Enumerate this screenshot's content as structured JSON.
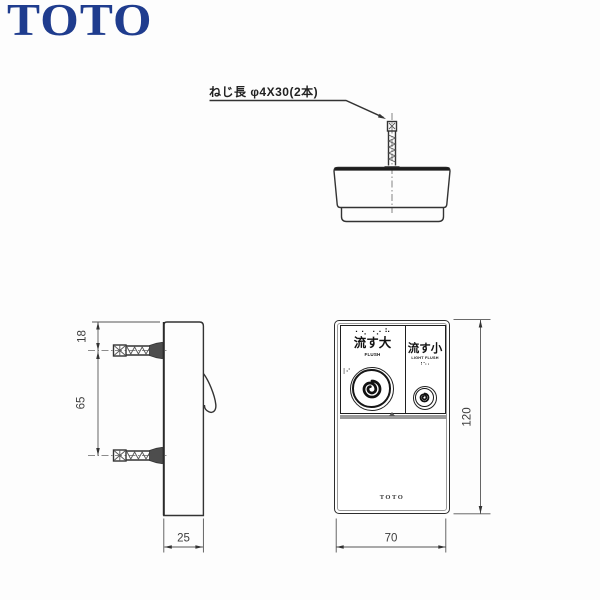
{
  "page": {
    "background": "#fdfdfd"
  },
  "header": {
    "brand_logo": "TOTO",
    "brand_color": "#1f3c8e"
  },
  "annotation": {
    "screw_note": "ねじ長 φ4X30(2本)"
  },
  "dimensions": {
    "top_to_first_screw": "18",
    "screw_spacing": "65",
    "depth": "25",
    "width": "70",
    "height": "120"
  },
  "front_view": {
    "large_flush_button": {
      "braille_top": "⠂⠢ ⠐⠔ ⠓",
      "label": "流す大",
      "sublabel": "FLUSH",
      "braille_side": "⠸⠊",
      "icon": "swirl-icon"
    },
    "light_flush_button": {
      "label": "流す小",
      "sublabel": "LIGHT FLUSH",
      "braille": "⠰⠢⠄",
      "icon": "swirl-icon"
    },
    "device_logo": "TOTO"
  },
  "colors": {
    "line": "#333333",
    "gray_band": "#999999",
    "flange": "#4d4d4d"
  }
}
